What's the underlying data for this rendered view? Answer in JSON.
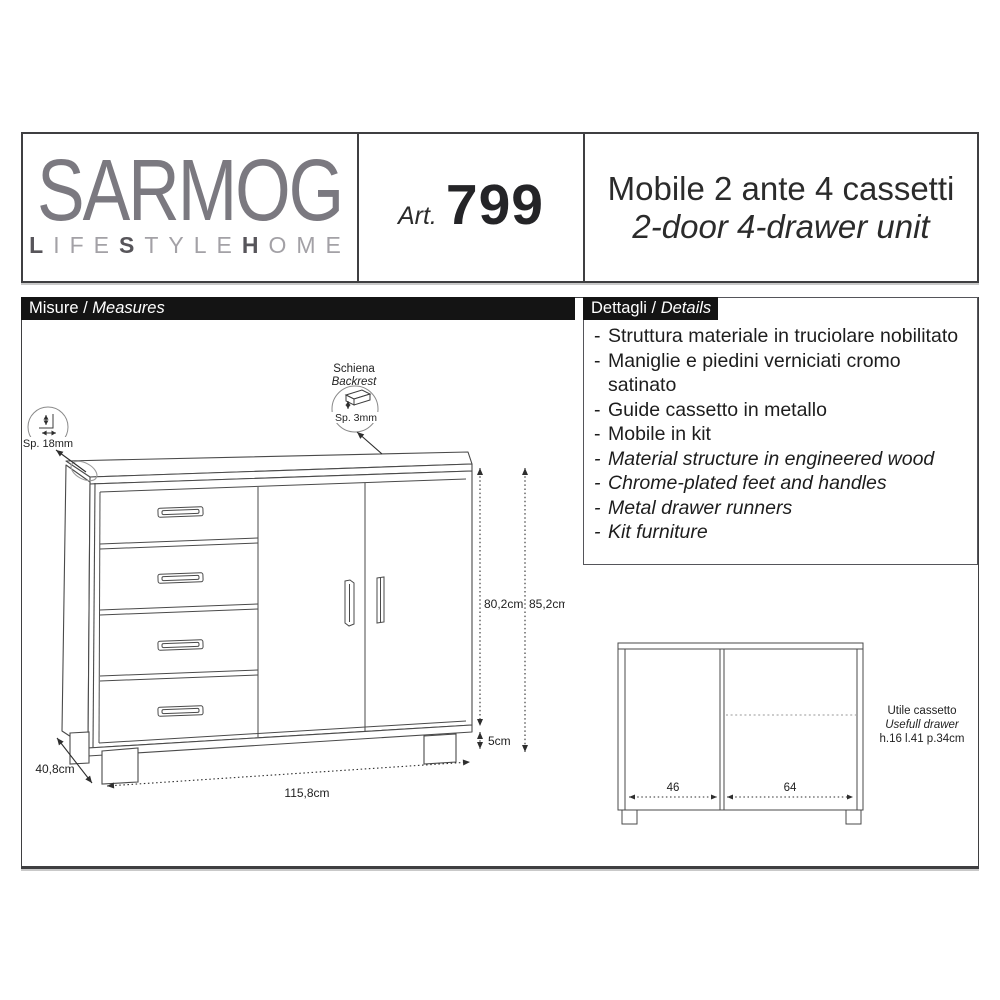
{
  "header": {
    "brand": {
      "name": "SARMOG",
      "tagline_parts": [
        "L",
        "IFE",
        "S",
        "TYLE",
        "H",
        "OME"
      ]
    },
    "article": {
      "prefix": "Art.",
      "number": "799"
    },
    "title": {
      "line1": "Mobile 2 ante 4 cassetti",
      "line2": "2-door 4-drawer unit"
    }
  },
  "sections": {
    "measures": {
      "label_it": "Misure",
      "separator": " / ",
      "label_en": "Measures"
    },
    "details": {
      "label_it": "Dettagli",
      "separator": " / ",
      "label_en": "Details"
    }
  },
  "details": {
    "bullet": "-",
    "items_it": [
      "Struttura materiale in truciolare nobilitato",
      "Maniglie e piedini verniciati cromo satinato",
      "Guide cassetto in metallo",
      "Mobile in kit"
    ],
    "items_en": [
      "Material structure in engineered wood",
      "Chrome-plated feet and handles",
      "Metal drawer runners",
      "Kit furniture"
    ]
  },
  "drawing": {
    "backrest_callout": {
      "label_it": "Schiena",
      "label_en": "Backrest",
      "thickness": "Sp. 3mm"
    },
    "side_callout": {
      "thickness": "Sp. 18mm"
    },
    "dimensions": {
      "body_height": "80,2cm",
      "total_height": "85,2cm",
      "feet_height": "5cm",
      "width": "115,8cm",
      "depth": "40,8cm"
    }
  },
  "interior": {
    "left_width": "46",
    "right_width": "64",
    "note": {
      "line1": "Utile cassetto",
      "line2": "Usefull drawer",
      "line3": "h.16 l.41 p.34cm"
    }
  }
}
